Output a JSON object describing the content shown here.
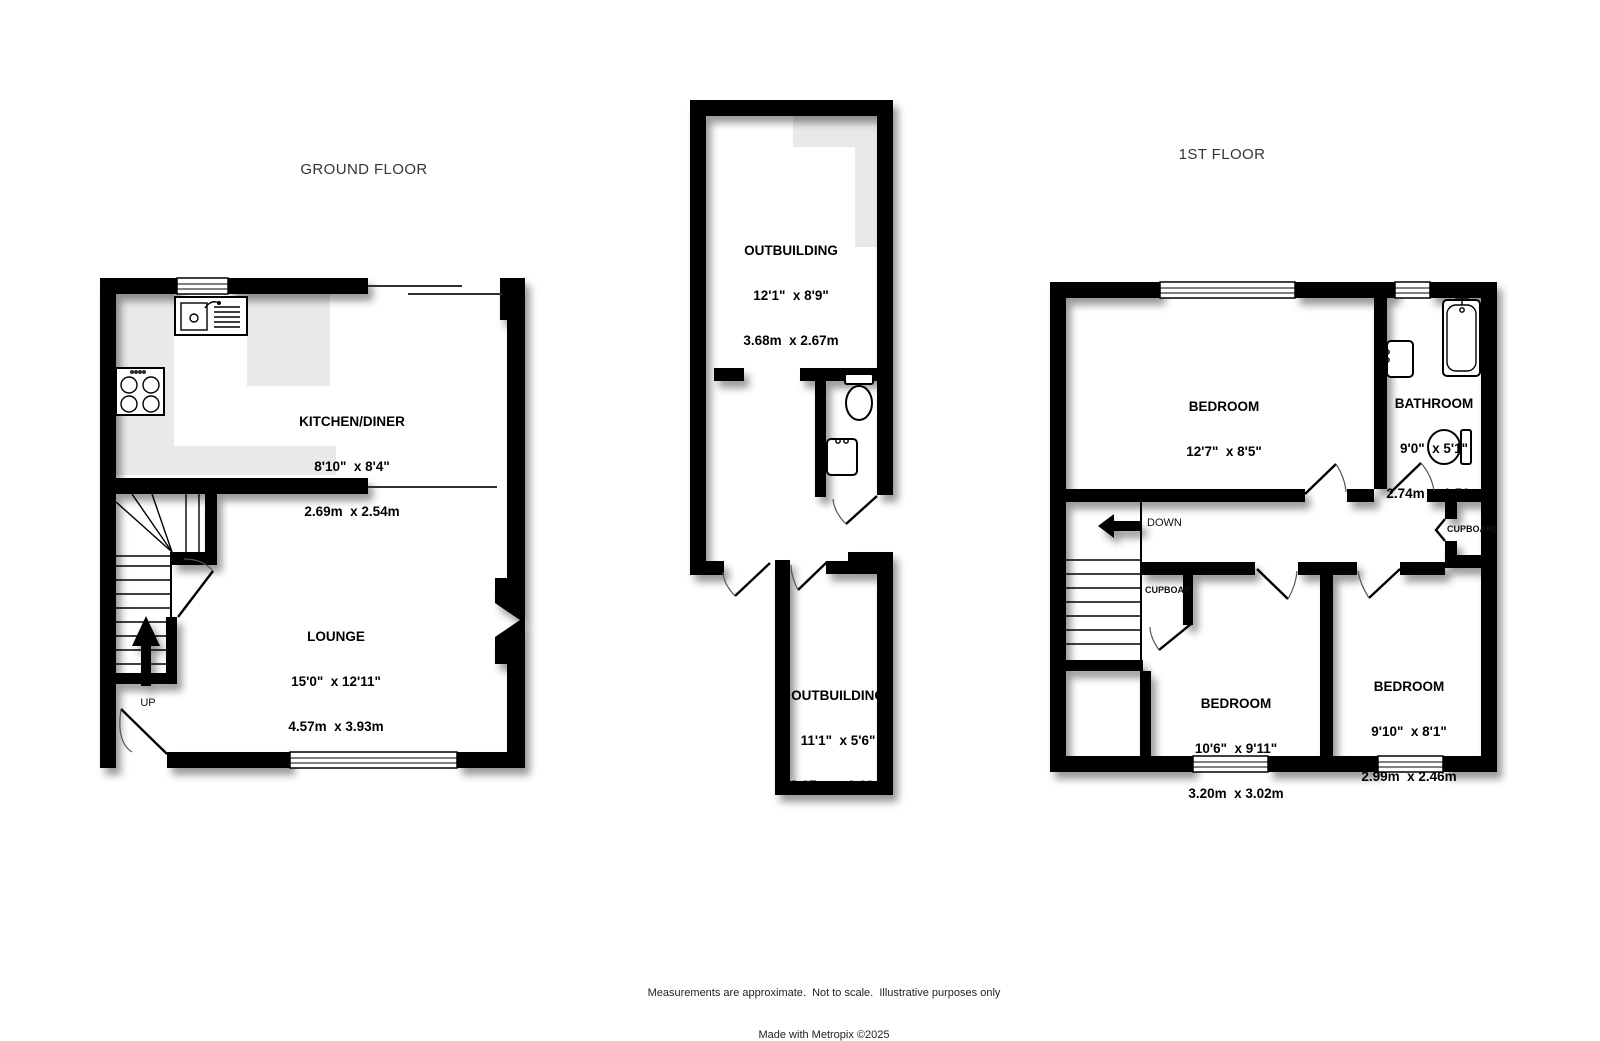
{
  "titles": {
    "ground_floor": "GROUND FLOOR",
    "first_floor": "1ST FLOOR"
  },
  "rooms": {
    "kitchen": {
      "name": "KITCHEN/DINER",
      "imperial": "8'10\"  x 8'4\"",
      "metric": "2.69m  x 2.54m"
    },
    "lounge": {
      "name": "LOUNGE",
      "imperial": "15'0\"  x 12'11\"",
      "metric": "4.57m  x 3.93m"
    },
    "outbuilding_top": {
      "name": "OUTBUILDING",
      "imperial": "12'1\"  x 8'9\"",
      "metric": "3.68m  x 2.67m"
    },
    "outbuilding_bottom": {
      "name": "OUTBUILDING",
      "imperial": "11'1\"  x 5'6\"",
      "metric": "3.37m  x 1.69m"
    },
    "bedroom_1": {
      "name": "BEDROOM",
      "imperial": "12'7\"  x 8'5\"",
      "metric": "3.83m  x 2.56m"
    },
    "bathroom": {
      "name": "BATHROOM",
      "imperial": "9'0\"  x 5'1\"",
      "metric": "2.74m  x 1.56m"
    },
    "bedroom_2": {
      "name": "BEDROOM",
      "imperial": "10'6\"  x 9'11\"",
      "metric": "3.20m  x 3.02m"
    },
    "bedroom_3": {
      "name": "BEDROOM",
      "imperial": "9'10\"  x 8'1\"",
      "metric": "2.99m  x 2.46m"
    }
  },
  "annotations": {
    "up": "UP",
    "down": "DOWN",
    "cupboard_left": "CUPBOARD",
    "cupboard_right": "CUPBOARD"
  },
  "footer": {
    "line1": "Measurements are approximate.  Not to scale.  Illustrative purposes only",
    "line2": "Made with Metropix ©2025"
  },
  "colors": {
    "wall": "#000000",
    "floor": "#ffffff",
    "counter": "#e9e9e9",
    "background": "#ffffff"
  }
}
